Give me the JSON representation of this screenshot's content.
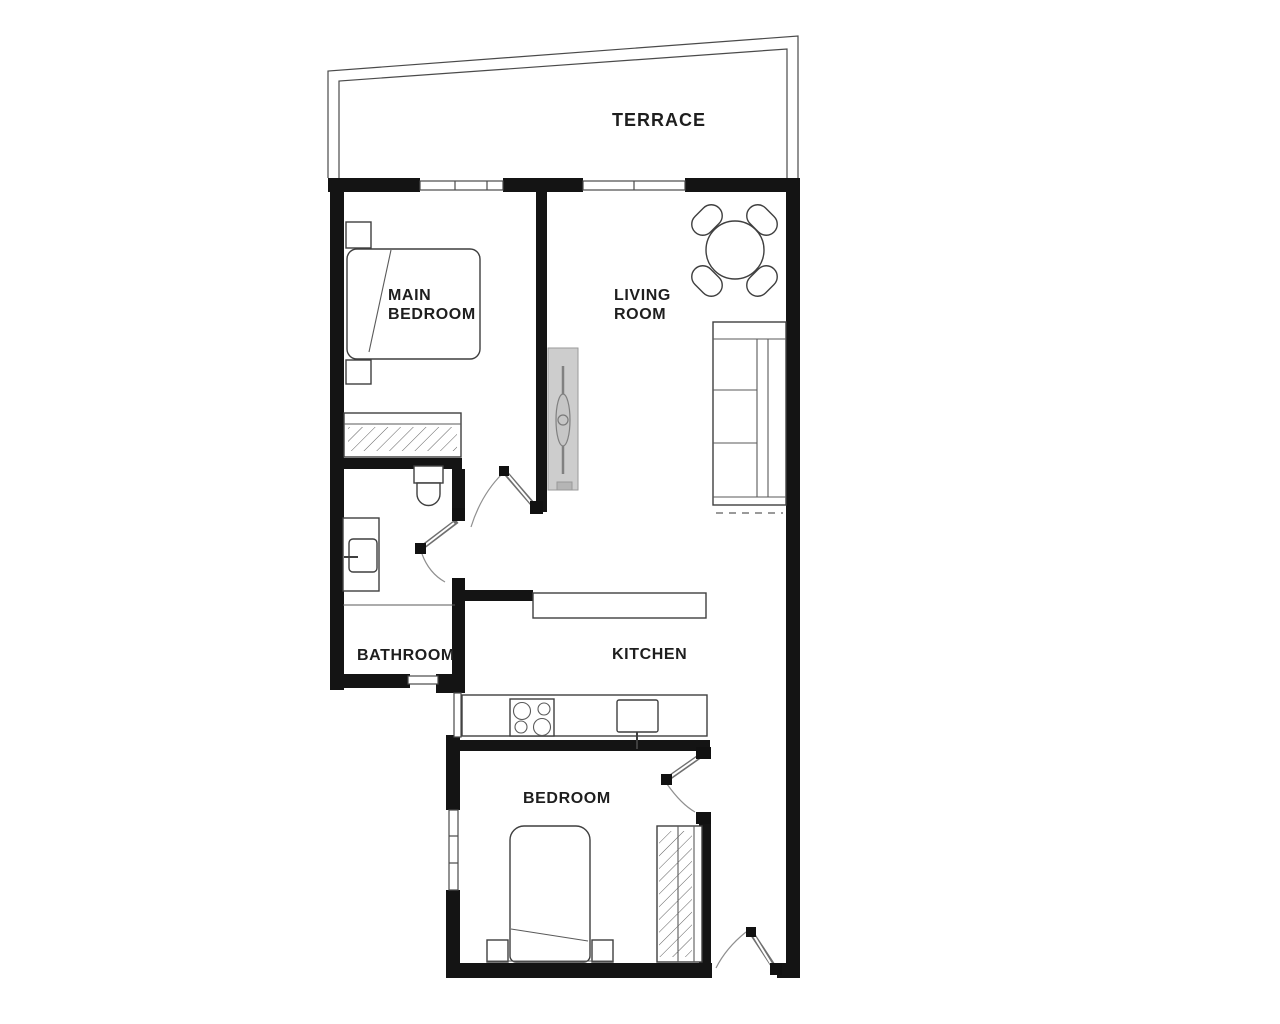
{
  "plan": {
    "title": "apartment-floor-plan",
    "rooms": {
      "terrace": {
        "label": "TERRACE"
      },
      "main_bedroom": {
        "label_line1": "MAIN",
        "label_line2": "BEDROOM"
      },
      "living_room": {
        "label_line1": "LIVING",
        "label_line2": "ROOM"
      },
      "bathroom": {
        "label": "BATHROOM"
      },
      "kitchen": {
        "label": "KITCHEN"
      },
      "bedroom": {
        "label": "BEDROOM"
      }
    },
    "furniture_icons": [
      "double-bed-icon",
      "nightstand-icon",
      "wardrobe-icon",
      "toilet-icon",
      "washbasin-icon",
      "dining-table-icon",
      "chair-icon",
      "sofa-icon",
      "tv-cabinet-icon",
      "kitchen-counter-icon",
      "hob-icon",
      "kitchen-sink-icon",
      "single-bed-icon",
      "door-swing-icon",
      "window-icon"
    ],
    "colors": {
      "wall": "#141414",
      "outline": "#3f3f3f",
      "cabinet_fill": "#cdcdcd",
      "background": "#ffffff"
    }
  }
}
